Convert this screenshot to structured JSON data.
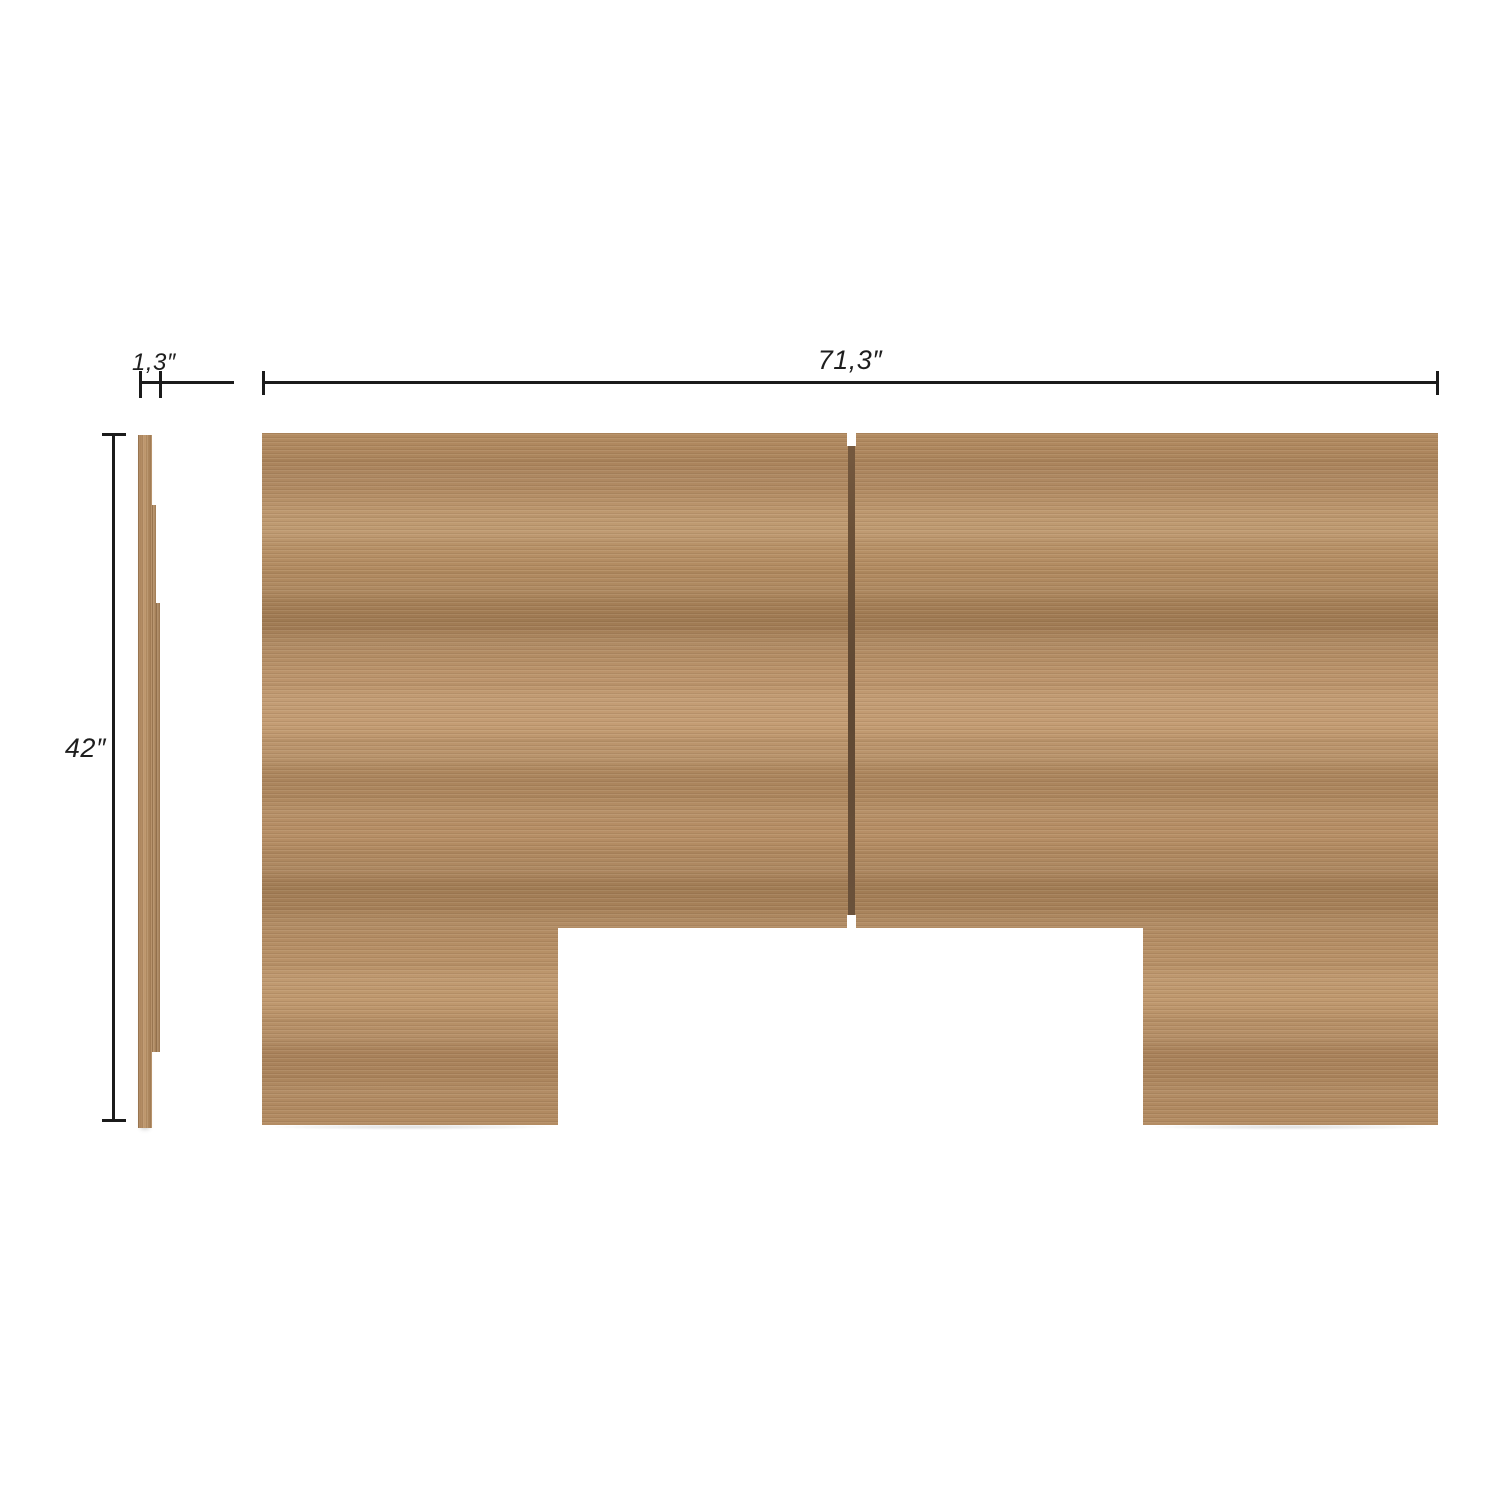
{
  "diagram": {
    "kind": "furniture-dimension-diagram",
    "subject": "wooden headboard panel, front view and side profile view",
    "units": "inches",
    "dimensions": {
      "thickness": {
        "value": "1,3",
        "label": "1,3″"
      },
      "width": {
        "value": "71,3",
        "label": "71,3″"
      },
      "height": {
        "value": "42",
        "label": "42″"
      }
    },
    "features": {
      "front_view": "two wood panels joined by a dark center seam, rectangular notch cut out of bottom center forming two legs",
      "side_view": "thin full-height panel with thicker stepped rail section in the middle"
    },
    "colors": {
      "background": "#ffffff",
      "wood_base": "#b08a61",
      "wood_light": "#c49d74",
      "wood_dark": "#9e7952",
      "seam": "#6b5138",
      "dimension_line": "#1b1b1b"
    }
  }
}
